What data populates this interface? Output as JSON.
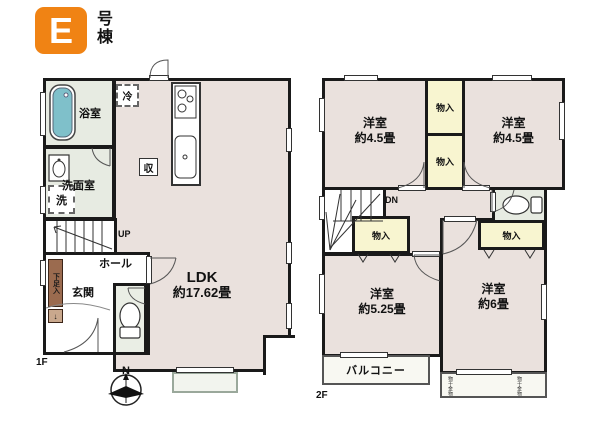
{
  "badge": {
    "letter": "E",
    "suffix": "号棟"
  },
  "colors": {
    "badge_orange": "#f08314",
    "room_pink": "#eae1dd",
    "service_green": "#e7ebe2",
    "closet_yellow": "#f8f5d0",
    "tub_teal": "#7fc0ca",
    "shoe_brown": "#9b6b4f",
    "wall_black": "#1a1a1a"
  },
  "floor1": {
    "label": "1F",
    "bathroom": "浴室",
    "washroom": "洗面室",
    "washer": "洗",
    "fridge": "冷",
    "storage": "収",
    "stairs": "UP",
    "hall": "ホール",
    "entrance": "玄関",
    "shoe_cabinet": "下足入",
    "shoe_arrow": "↓",
    "ldk_name": "LDK",
    "ldk_size": "約17.62畳"
  },
  "floor2": {
    "label": "2F",
    "rooms": [
      {
        "name": "洋室",
        "size": "約4.5畳"
      },
      {
        "name": "洋室",
        "size": "約4.5畳"
      },
      {
        "name": "洋室",
        "size": "約5.25畳"
      },
      {
        "name": "洋室",
        "size": "約6畳"
      }
    ],
    "closets": [
      "物入",
      "物入",
      "物入",
      "物入"
    ],
    "stairs": "DN",
    "balcony": "バルコニー",
    "balcony_notes": [
      "物干金物",
      "物干金物"
    ]
  },
  "compass": {
    "north": "N"
  }
}
